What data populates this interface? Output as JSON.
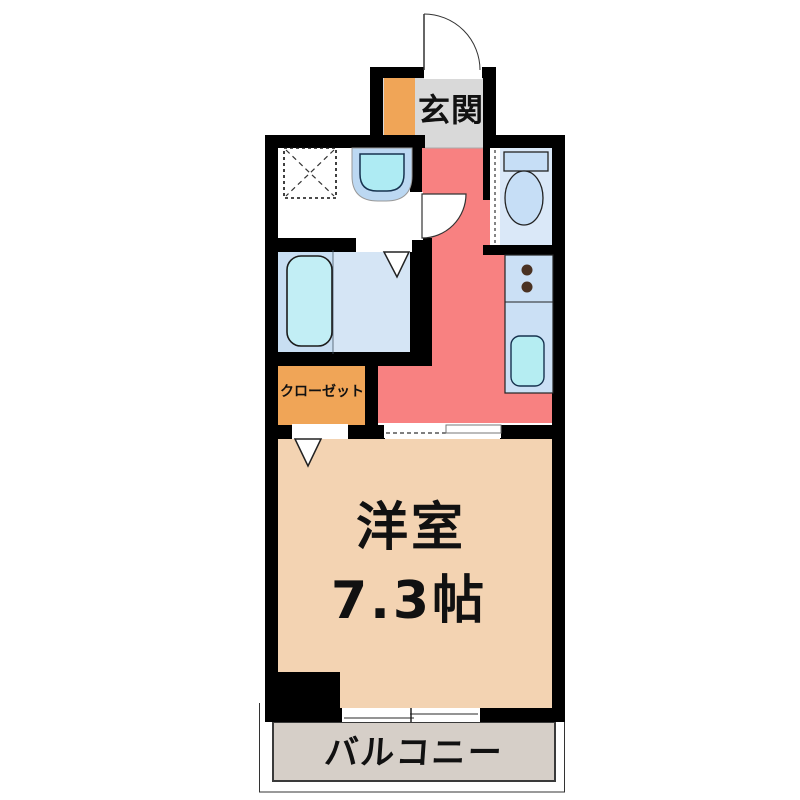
{
  "floorplan": {
    "type": "japanese-apartment-floor-plan",
    "rooms": {
      "genkan": {
        "label": "玄関"
      },
      "closet": {
        "label": "クローゼット"
      },
      "main_room": {
        "label": "洋室",
        "size": "7.3帖"
      },
      "balcony": {
        "label": "バルコニー"
      }
    },
    "fixtures": [
      "entrance-door-arc",
      "shoe-cabinet",
      "washing-machine-space",
      "wash-basin",
      "washroom-door-arc",
      "bathtub",
      "bathroom-door-marker",
      "toilet",
      "toilet-door",
      "kitchen-counter",
      "stove-burners",
      "kitchen-sink",
      "closet-door-marker",
      "sliding-door",
      "sliding-window"
    ],
    "colors": {
      "wall": "#000000",
      "hallway_kitchen": "#F88181",
      "main_room": "#F3D3B2",
      "closet": "#F0A557",
      "genkan": "#D9D9D9",
      "balcony": "#D6CFC8",
      "bath_floor": "#D5E5F5",
      "toilet_floor": "#DAE8F8",
      "counter": "#CBE0F5",
      "water_fixture": "#B5EDF2",
      "tub": "#C2EEF5"
    }
  }
}
